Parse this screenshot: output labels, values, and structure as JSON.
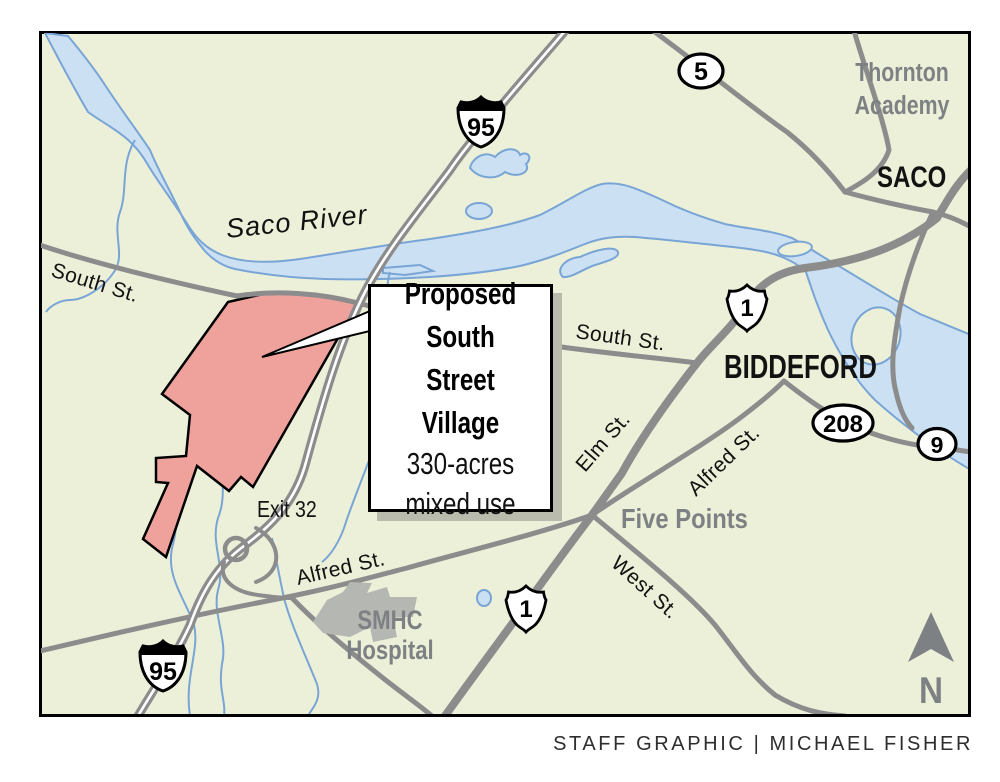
{
  "colors": {
    "land": "#edf0d9",
    "water": "#cbe0f2",
    "water_edge": "#79a5d6",
    "road": "#8c8c8c",
    "highway_center": "#ffffff",
    "site_fill": "#efa19c",
    "site_edge": "#000000",
    "hospital": "#b5b7b3",
    "gray_text": "#7d8184",
    "black_text": "#121212",
    "frame": "#000000",
    "shadow": "#b9bbad"
  },
  "callout": {
    "title_line1": "Proposed",
    "title_line2": "South Street",
    "title_line3": "Village",
    "subtitle_line1": "330-acres",
    "subtitle_line2": "mixed use"
  },
  "shields": {
    "interstate_95": "95",
    "us_1": "1",
    "route_5": "5",
    "route_208": "208",
    "route_9": "9"
  },
  "labels": {
    "saco_river": "Saco River",
    "south_st_west": "South St.",
    "south_st_east": "South St.",
    "elm_st": "Elm St.",
    "alfred_st_northeast": "Alfred St.",
    "alfred_st_west": "Alfred St.",
    "west_st": "West St.",
    "exit_32": "Exit 32",
    "five_points": "Five Points",
    "biddeford": "BIDDEFORD",
    "saco": "SACO",
    "thornton_academy_line1": "Thornton",
    "thornton_academy_line2": "Academy",
    "smhc_line1": "SMHC",
    "smhc_line2": "Hospital",
    "north_arrow": "N"
  },
  "credit": "STAFF GRAPHIC | MICHAEL FISHER"
}
